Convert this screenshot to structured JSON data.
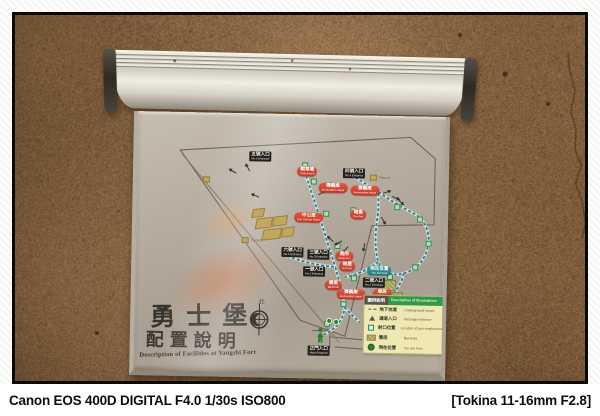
{
  "caption": {
    "left": "Canon EOS 400D DIGITAL F4.0 1/30s ISO800",
    "right": "[Tokina 11-16mm F2.8]"
  },
  "sign": {
    "title_zh": "勇士堡",
    "subtitle_zh": "配置說明",
    "title_en": "Description of Facilities at Yangshi Fort",
    "compass_north": "北",
    "legend": {
      "header_zh": "圖例說明",
      "header_en": "Description of Illustrations",
      "items": [
        {
          "icon": "dash",
          "zh": "地下坑道",
          "en": "Underground tunnel"
        },
        {
          "icon": "tri",
          "zh": "通道入口",
          "en": "Passage entrance"
        },
        {
          "icon": "sq",
          "zh": "射口位置",
          "en": "Location of gun emplacement"
        },
        {
          "icon": "hatch",
          "zh": "營房",
          "en": "Barracks"
        },
        {
          "icon": "person",
          "zh": "現在位置",
          "en": "You are here"
        }
      ]
    },
    "map": {
      "entrances": [
        {
          "zh": "五號入口",
          "en": "No.5 Entrance",
          "x": 112,
          "y": 38
        },
        {
          "zh": "四號入口",
          "en": "No.4 Entrance",
          "x": 206,
          "y": 53
        },
        {
          "zh": "六號入口",
          "en": "No.6 Entrance",
          "x": 146,
          "y": 133
        },
        {
          "zh": "三號入口",
          "en": "No.3 Entrance",
          "x": 172,
          "y": 135
        },
        {
          "zh": "一號入口",
          "en": "No.1 Entrance",
          "x": 168,
          "y": 152
        },
        {
          "zh": "二號入口",
          "en": "No.2 Entrance",
          "x": 228,
          "y": 162
        },
        {
          "zh": "正門入口",
          "en": "Main Entrance",
          "x": 174,
          "y": 231
        }
      ],
      "facilities": [
        {
          "zh": "戰車壕",
          "en": "Tank trench",
          "x": 160,
          "y": 52
        },
        {
          "zh": "彈藥庫",
          "en": "Ammunition depot",
          "x": 182,
          "y": 68
        },
        {
          "zh": "中山室",
          "en": "Sun Yat-sen Room",
          "x": 158,
          "y": 98
        },
        {
          "zh": "彈藥庫",
          "en": "Ammunition depot",
          "x": 214,
          "y": 70
        },
        {
          "zh": "砲堡",
          "en": "Gun fort",
          "x": 214,
          "y": 94
        },
        {
          "zh": "廁所",
          "en": "Restroom",
          "x": 200,
          "y": 136
        },
        {
          "zh": "砲堡",
          "en": "Gun fort",
          "x": 204,
          "y": 146
        },
        {
          "zh": "寢室",
          "en": "Bedroom",
          "x": 190,
          "y": 165
        },
        {
          "zh": "彈藥庫",
          "en": "Ammunition depot",
          "x": 202,
          "y": 174
        },
        {
          "zh": "庫房",
          "en": "Storeroom",
          "x": 238,
          "y": 173
        }
      ],
      "you_are_here": {
        "zh": "現在位置",
        "en": "You are here",
        "x": 232,
        "y": 150
      },
      "trenches": [
        {
          "label": "Trench",
          "x": 233,
          "y": 59
        },
        {
          "label": "Trench",
          "x": 106,
          "y": 124
        },
        {
          "label": "",
          "x": 66,
          "y": 64
        }
      ],
      "cannons": [
        {
          "x": 91,
          "y": 56,
          "r": -150
        },
        {
          "x": 106,
          "y": 52,
          "r": -120
        },
        {
          "x": 114,
          "y": 80,
          "r": -160
        },
        {
          "x": 188,
          "y": 69,
          "r": -60
        },
        {
          "x": 181,
          "y": 76,
          "r": -30
        },
        {
          "x": 246,
          "y": 74,
          "r": -20
        },
        {
          "x": 255,
          "y": 80,
          "r": 20
        },
        {
          "x": 260,
          "y": 84,
          "r": 45
        },
        {
          "x": 243,
          "y": 103,
          "r": 60
        },
        {
          "x": 190,
          "y": 122,
          "r": -140
        },
        {
          "x": 198,
          "y": 126,
          "r": 150
        },
        {
          "x": 205,
          "y": 133,
          "r": 130
        },
        {
          "x": 224,
          "y": 130,
          "r": 100
        }
      ],
      "emplacements": [
        {
          "x": 165,
          "y": 48
        },
        {
          "x": 174,
          "y": 64
        },
        {
          "x": 187,
          "y": 96
        },
        {
          "x": 199,
          "y": 128
        },
        {
          "x": 214,
          "y": 92
        },
        {
          "x": 258,
          "y": 88
        },
        {
          "x": 281,
          "y": 100
        },
        {
          "x": 290,
          "y": 124
        },
        {
          "x": 277,
          "y": 148
        },
        {
          "x": 252,
          "y": 158
        },
        {
          "x": 216,
          "y": 160
        },
        {
          "x": 206,
          "y": 186
        },
        {
          "x": 190,
          "y": 206
        }
      ],
      "buildings": [
        {
          "x": 120,
          "y": 104,
          "w": 14,
          "h": 9
        },
        {
          "x": 137,
          "y": 102,
          "w": 12,
          "h": 8
        },
        {
          "x": 127,
          "y": 115,
          "w": 16,
          "h": 9
        },
        {
          "x": 146,
          "y": 113,
          "w": 10,
          "h": 8
        },
        {
          "x": 116,
          "y": 95,
          "w": 10,
          "h": 7
        }
      ],
      "barracks_boxes": [
        {
          "x": 243,
          "y": 164,
          "w": 16,
          "h": 9
        },
        {
          "x": 250,
          "y": 176,
          "w": 16,
          "h": 9
        }
      ],
      "paths": {
        "outline": [
          "M43,38 L273,21 L298,42 L298,108 L236,110 L211,221 L166,206 Z",
          "M178,216 L196,216 L196,233 L178,233",
          "M196,222 L296,229 M201,232 L288,237"
        ],
        "roads": [
          "M45,42 L203,224",
          "M50,48 L206,228"
        ],
        "tunnels": [
          "M166,52 C172,70 180,92 188,116 C193,132 197,142 200,152",
          "M200,152 C205,168 209,180 210,192 C210,204 202,214 190,220",
          "M152,142 C166,147 182,151 200,152",
          "M214,60 C222,64 232,70 242,76",
          "M242,76 C254,85 268,92 281,99 C291,107 295,119 292,131 C289,145 281,153 269,157 C257,161 247,156 243,146 C239,134 239,115 242,97 C242,90 242,83 242,76",
          "M243,146 C233,154 221,160 210,162",
          "M269,157 C266,167 262,175 256,181",
          "M210,192 C216,198 221,203 226,207"
        ]
      }
    }
  },
  "colors": {
    "wall": "#7d5c3c",
    "board": "#b3aa9c",
    "label_red": "#c9392a",
    "label_black": "#24221e",
    "label_teal": "#2f8f96",
    "legend_bg": "#efe8b2",
    "legend_header_green": "#2e9a4e",
    "tunnel_teal": "#2a7f8a",
    "building_tan": "#c2a75e",
    "person_green": "#2e7d32"
  }
}
